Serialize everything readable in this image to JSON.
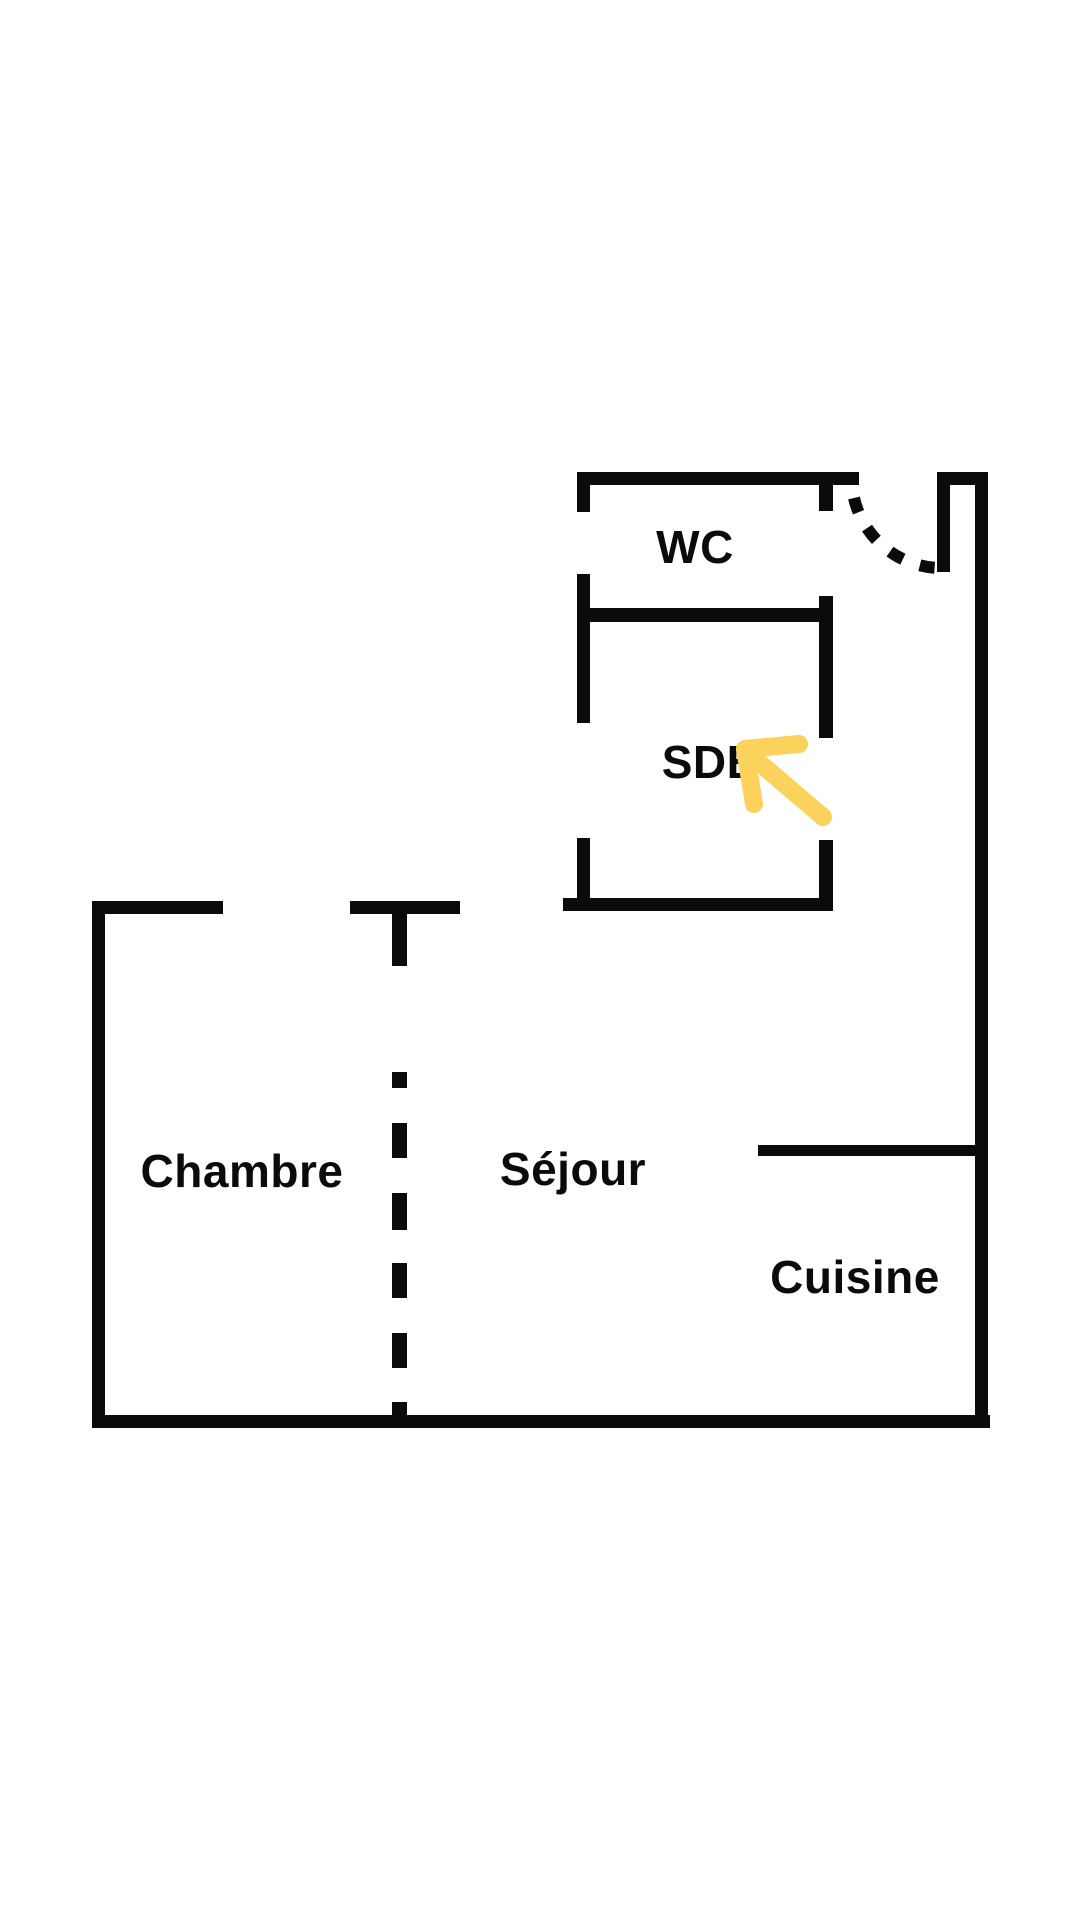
{
  "title": "Apartment floor plan",
  "colors": {
    "background": "#ffffff",
    "wall": "#0b0b0b",
    "label_text": "#0b0b0b",
    "arrow": "#fbd35c"
  },
  "floor_plan": {
    "rooms": [
      {
        "id": "wc",
        "label": "WC"
      },
      {
        "id": "sdb",
        "label": "SDB"
      },
      {
        "id": "chambre",
        "label": "Chambre"
      },
      {
        "id": "sejour",
        "label": "Séjour"
      },
      {
        "id": "cuisine",
        "label": "Cuisine"
      }
    ],
    "annotations": {
      "highlight_arrow": {
        "shape": "arrow-pointing-up-left",
        "target_room": "SDB",
        "color": "#fbd35c"
      },
      "door_swing": {
        "shape": "dashed-quarter-arc",
        "location": "entry-door-top-right"
      },
      "partition": {
        "shape": "dashed-vertical-line",
        "between": "Chambre / Séjour"
      }
    }
  }
}
